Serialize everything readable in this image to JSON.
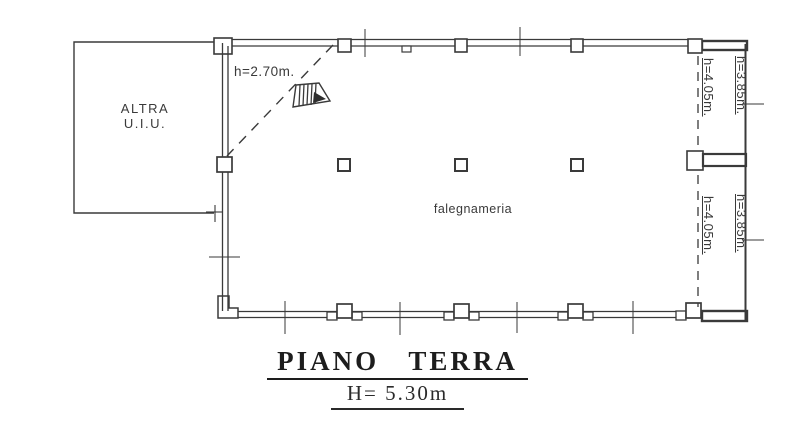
{
  "drawing": {
    "title": "PIANO TERRA",
    "subtitle": "H= 5.30m",
    "altra_room": {
      "line1": "ALTRA",
      "line2": "U.I.U."
    },
    "main_room_label": "falegnameria",
    "stairs_height_label": "h=2.70m.",
    "right_zone_labels": {
      "upper_left": "h=4.05m.",
      "upper_right": "h=3.85m.",
      "lower_left": "h=4.05m.",
      "lower_right": "h=3.85m."
    }
  },
  "colors": {
    "ink": "#2e2e2e",
    "paper": "#ffffff"
  }
}
